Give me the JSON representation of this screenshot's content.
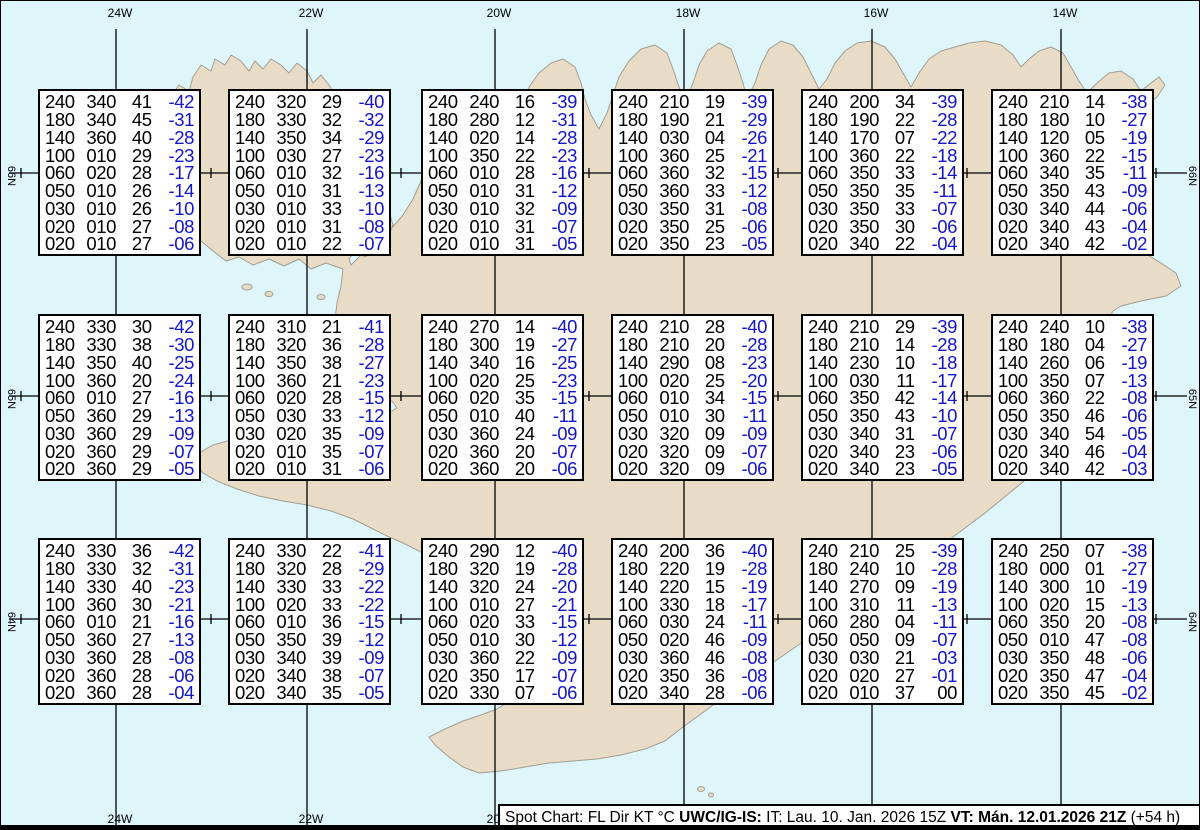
{
  "map": {
    "meridian_labels": [
      "24W",
      "22W",
      "20W",
      "18W",
      "16W",
      "14W"
    ],
    "parallel_labels": [
      "66N",
      "65N",
      "64N"
    ]
  },
  "footer": {
    "segments": [
      {
        "text": "Spot Chart: FL Dir KT °C ",
        "bold": false
      },
      {
        "text": "UWC/IG-IS:",
        "bold": true
      },
      {
        "text": " IT: Lau. 10. Jan. 2026 15Z ",
        "bold": false
      },
      {
        "text": "VT: Mán. 12.01.2026 21Z",
        "bold": true
      },
      {
        "text": " (+54 h)",
        "bold": false
      }
    ]
  },
  "colors": {
    "water": "#def5fa",
    "land": "#e8dcc6",
    "coast": "#a39d92",
    "grid": "#000000",
    "text": "#000000",
    "temp_negative": "#1414cc",
    "box_background": "#ffffff"
  },
  "boxes": [
    {
      "row": 0,
      "col": 0,
      "rows": [
        [
          "240",
          "340",
          "41",
          "-42"
        ],
        [
          "180",
          "340",
          "45",
          "-31"
        ],
        [
          "140",
          "360",
          "40",
          "-28"
        ],
        [
          "100",
          "010",
          "29",
          "-23"
        ],
        [
          "060",
          "020",
          "28",
          "-17"
        ],
        [
          "050",
          "010",
          "26",
          "-14"
        ],
        [
          "030",
          "010",
          "26",
          "-10"
        ],
        [
          "020",
          "010",
          "27",
          "-08"
        ],
        [
          "020",
          "010",
          "27",
          "-06"
        ]
      ]
    },
    {
      "row": 0,
      "col": 1,
      "rows": [
        [
          "240",
          "320",
          "29",
          "-40"
        ],
        [
          "180",
          "330",
          "32",
          "-32"
        ],
        [
          "140",
          "350",
          "34",
          "-29"
        ],
        [
          "100",
          "030",
          "27",
          "-23"
        ],
        [
          "060",
          "010",
          "32",
          "-16"
        ],
        [
          "050",
          "010",
          "31",
          "-13"
        ],
        [
          "030",
          "010",
          "33",
          "-10"
        ],
        [
          "020",
          "010",
          "31",
          "-08"
        ],
        [
          "020",
          "010",
          "22",
          "-07"
        ]
      ]
    },
    {
      "row": 0,
      "col": 2,
      "rows": [
        [
          "240",
          "240",
          "16",
          "-39"
        ],
        [
          "180",
          "280",
          "12",
          "-31"
        ],
        [
          "140",
          "020",
          "14",
          "-28"
        ],
        [
          "100",
          "350",
          "22",
          "-23"
        ],
        [
          "060",
          "010",
          "28",
          "-16"
        ],
        [
          "050",
          "010",
          "31",
          "-12"
        ],
        [
          "030",
          "010",
          "32",
          "-09"
        ],
        [
          "020",
          "010",
          "31",
          "-07"
        ],
        [
          "020",
          "010",
          "31",
          "-05"
        ]
      ]
    },
    {
      "row": 0,
      "col": 3,
      "rows": [
        [
          "240",
          "210",
          "19",
          "-39"
        ],
        [
          "180",
          "190",
          "21",
          "-29"
        ],
        [
          "140",
          "030",
          "04",
          "-26"
        ],
        [
          "100",
          "360",
          "25",
          "-21"
        ],
        [
          "060",
          "360",
          "32",
          "-15"
        ],
        [
          "050",
          "360",
          "33",
          "-12"
        ],
        [
          "030",
          "350",
          "31",
          "-08"
        ],
        [
          "020",
          "350",
          "25",
          "-06"
        ],
        [
          "020",
          "350",
          "23",
          "-05"
        ]
      ]
    },
    {
      "row": 0,
      "col": 4,
      "rows": [
        [
          "240",
          "200",
          "34",
          "-39"
        ],
        [
          "180",
          "190",
          "22",
          "-28"
        ],
        [
          "140",
          "170",
          "07",
          "-22"
        ],
        [
          "100",
          "360",
          "22",
          "-18"
        ],
        [
          "060",
          "350",
          "33",
          "-14"
        ],
        [
          "050",
          "350",
          "35",
          "-11"
        ],
        [
          "030",
          "350",
          "33",
          "-07"
        ],
        [
          "020",
          "350",
          "30",
          "-06"
        ],
        [
          "020",
          "340",
          "22",
          "-04"
        ]
      ]
    },
    {
      "row": 0,
      "col": 5,
      "rows": [
        [
          "240",
          "210",
          "14",
          "-38"
        ],
        [
          "180",
          "180",
          "10",
          "-27"
        ],
        [
          "140",
          "120",
          "05",
          "-19"
        ],
        [
          "100",
          "360",
          "22",
          "-15"
        ],
        [
          "060",
          "340",
          "35",
          "-11"
        ],
        [
          "050",
          "350",
          "43",
          "-09"
        ],
        [
          "030",
          "340",
          "44",
          "-06"
        ],
        [
          "020",
          "340",
          "43",
          "-04"
        ],
        [
          "020",
          "340",
          "42",
          "-02"
        ]
      ]
    },
    {
      "row": 1,
      "col": 0,
      "rows": [
        [
          "240",
          "330",
          "30",
          "-42"
        ],
        [
          "180",
          "330",
          "38",
          "-30"
        ],
        [
          "140",
          "350",
          "40",
          "-25"
        ],
        [
          "100",
          "360",
          "20",
          "-24"
        ],
        [
          "060",
          "010",
          "27",
          "-16"
        ],
        [
          "050",
          "360",
          "29",
          "-13"
        ],
        [
          "030",
          "360",
          "29",
          "-09"
        ],
        [
          "020",
          "360",
          "29",
          "-07"
        ],
        [
          "020",
          "360",
          "29",
          "-05"
        ]
      ]
    },
    {
      "row": 1,
      "col": 1,
      "rows": [
        [
          "240",
          "310",
          "21",
          "-41"
        ],
        [
          "180",
          "320",
          "36",
          "-28"
        ],
        [
          "140",
          "350",
          "38",
          "-27"
        ],
        [
          "100",
          "360",
          "21",
          "-23"
        ],
        [
          "060",
          "020",
          "28",
          "-15"
        ],
        [
          "050",
          "030",
          "33",
          "-12"
        ],
        [
          "030",
          "020",
          "35",
          "-09"
        ],
        [
          "020",
          "010",
          "35",
          "-07"
        ],
        [
          "020",
          "010",
          "31",
          "-06"
        ]
      ]
    },
    {
      "row": 1,
      "col": 2,
      "rows": [
        [
          "240",
          "270",
          "14",
          "-40"
        ],
        [
          "180",
          "300",
          "19",
          "-27"
        ],
        [
          "140",
          "340",
          "16",
          "-25"
        ],
        [
          "100",
          "020",
          "25",
          "-23"
        ],
        [
          "060",
          "020",
          "35",
          "-15"
        ],
        [
          "050",
          "010",
          "40",
          "-11"
        ],
        [
          "030",
          "360",
          "24",
          "-09"
        ],
        [
          "020",
          "360",
          "20",
          "-07"
        ],
        [
          "020",
          "360",
          "20",
          "-06"
        ]
      ]
    },
    {
      "row": 1,
      "col": 3,
      "rows": [
        [
          "240",
          "210",
          "28",
          "-40"
        ],
        [
          "180",
          "210",
          "20",
          "-28"
        ],
        [
          "140",
          "290",
          "08",
          "-23"
        ],
        [
          "100",
          "020",
          "25",
          "-20"
        ],
        [
          "060",
          "010",
          "34",
          "-15"
        ],
        [
          "050",
          "010",
          "30",
          "-11"
        ],
        [
          "030",
          "320",
          "09",
          "-09"
        ],
        [
          "020",
          "320",
          "09",
          "-07"
        ],
        [
          "020",
          "320",
          "09",
          "-06"
        ]
      ]
    },
    {
      "row": 1,
      "col": 4,
      "rows": [
        [
          "240",
          "210",
          "29",
          "-39"
        ],
        [
          "180",
          "210",
          "14",
          "-28"
        ],
        [
          "140",
          "230",
          "10",
          "-18"
        ],
        [
          "100",
          "030",
          "11",
          "-17"
        ],
        [
          "060",
          "350",
          "42",
          "-14"
        ],
        [
          "050",
          "350",
          "43",
          "-10"
        ],
        [
          "030",
          "340",
          "31",
          "-07"
        ],
        [
          "020",
          "340",
          "23",
          "-06"
        ],
        [
          "020",
          "340",
          "23",
          "-05"
        ]
      ]
    },
    {
      "row": 1,
      "col": 5,
      "rows": [
        [
          "240",
          "240",
          "10",
          "-38"
        ],
        [
          "180",
          "180",
          "04",
          "-27"
        ],
        [
          "140",
          "260",
          "06",
          "-19"
        ],
        [
          "100",
          "350",
          "07",
          "-13"
        ],
        [
          "060",
          "360",
          "22",
          "-08"
        ],
        [
          "050",
          "350",
          "46",
          "-06"
        ],
        [
          "030",
          "340",
          "54",
          "-05"
        ],
        [
          "020",
          "340",
          "46",
          "-04"
        ],
        [
          "020",
          "340",
          "42",
          "-03"
        ]
      ]
    },
    {
      "row": 2,
      "col": 0,
      "rows": [
        [
          "240",
          "330",
          "36",
          "-42"
        ],
        [
          "180",
          "330",
          "32",
          "-31"
        ],
        [
          "140",
          "330",
          "40",
          "-23"
        ],
        [
          "100",
          "360",
          "30",
          "-21"
        ],
        [
          "060",
          "010",
          "21",
          "-16"
        ],
        [
          "050",
          "360",
          "27",
          "-13"
        ],
        [
          "030",
          "360",
          "28",
          "-08"
        ],
        [
          "020",
          "360",
          "28",
          "-06"
        ],
        [
          "020",
          "360",
          "28",
          "-04"
        ]
      ]
    },
    {
      "row": 2,
      "col": 1,
      "rows": [
        [
          "240",
          "330",
          "22",
          "-41"
        ],
        [
          "180",
          "320",
          "28",
          "-29"
        ],
        [
          "140",
          "330",
          "33",
          "-22"
        ],
        [
          "100",
          "020",
          "33",
          "-22"
        ],
        [
          "060",
          "010",
          "36",
          "-15"
        ],
        [
          "050",
          "350",
          "39",
          "-12"
        ],
        [
          "030",
          "340",
          "39",
          "-09"
        ],
        [
          "020",
          "340",
          "38",
          "-07"
        ],
        [
          "020",
          "340",
          "35",
          "-05"
        ]
      ]
    },
    {
      "row": 2,
      "col": 2,
      "rows": [
        [
          "240",
          "290",
          "12",
          "-40"
        ],
        [
          "180",
          "320",
          "19",
          "-28"
        ],
        [
          "140",
          "320",
          "24",
          "-20"
        ],
        [
          "100",
          "010",
          "27",
          "-21"
        ],
        [
          "060",
          "020",
          "33",
          "-15"
        ],
        [
          "050",
          "010",
          "30",
          "-12"
        ],
        [
          "030",
          "360",
          "22",
          "-09"
        ],
        [
          "020",
          "350",
          "17",
          "-07"
        ],
        [
          "020",
          "330",
          "07",
          "-06"
        ]
      ]
    },
    {
      "row": 2,
      "col": 3,
      "rows": [
        [
          "240",
          "200",
          "36",
          "-40"
        ],
        [
          "180",
          "220",
          "19",
          "-28"
        ],
        [
          "140",
          "220",
          "15",
          "-19"
        ],
        [
          "100",
          "330",
          "18",
          "-17"
        ],
        [
          "060",
          "030",
          "24",
          "-11"
        ],
        [
          "050",
          "020",
          "46",
          "-09"
        ],
        [
          "030",
          "360",
          "46",
          "-08"
        ],
        [
          "020",
          "350",
          "36",
          "-08"
        ],
        [
          "020",
          "340",
          "28",
          "-06"
        ]
      ]
    },
    {
      "row": 2,
      "col": 4,
      "rows": [
        [
          "240",
          "210",
          "25",
          "-39"
        ],
        [
          "180",
          "240",
          "10",
          "-28"
        ],
        [
          "140",
          "270",
          "09",
          "-19"
        ],
        [
          "100",
          "310",
          "11",
          "-13"
        ],
        [
          "060",
          "280",
          "04",
          "-11"
        ],
        [
          "050",
          "050",
          "09",
          "-07"
        ],
        [
          "030",
          "030",
          "21",
          "-03"
        ],
        [
          "020",
          "020",
          "27",
          "-01"
        ],
        [
          "020",
          "010",
          "37",
          "00"
        ]
      ]
    },
    {
      "row": 2,
      "col": 5,
      "rows": [
        [
          "240",
          "250",
          "07",
          "-38"
        ],
        [
          "180",
          "000",
          "01",
          "-27"
        ],
        [
          "140",
          "300",
          "10",
          "-19"
        ],
        [
          "100",
          "020",
          "15",
          "-13"
        ],
        [
          "060",
          "350",
          "20",
          "-08"
        ],
        [
          "050",
          "010",
          "47",
          "-08"
        ],
        [
          "030",
          "350",
          "48",
          "-06"
        ],
        [
          "020",
          "350",
          "47",
          "-04"
        ],
        [
          "020",
          "350",
          "45",
          "-02"
        ]
      ]
    }
  ]
}
